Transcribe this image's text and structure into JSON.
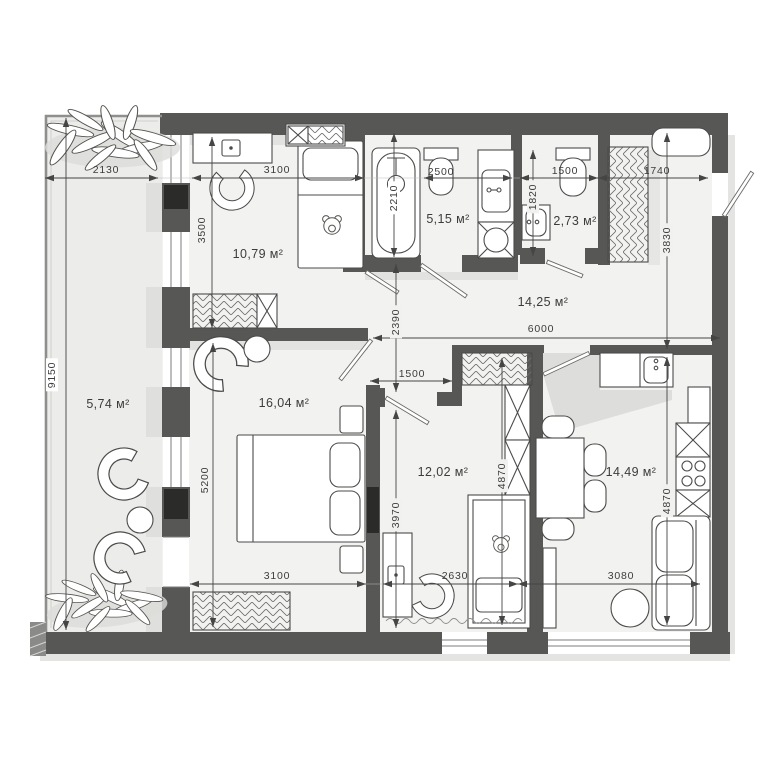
{
  "document": {
    "type": "apartment-floor-plan",
    "area_unit": "м²"
  },
  "colors": {
    "wall": "#575756",
    "floor": "#f2f2f0",
    "balcony_floor": "#ececea",
    "line": "#454544",
    "background": "#ffffff"
  },
  "rooms": [
    {
      "id": "balcony",
      "area_label": "5,74 м²",
      "furniture": [
        "plant",
        "lounge-chair",
        "side-table",
        "lounge-chair",
        "plant"
      ]
    },
    {
      "id": "bedroom-top",
      "area_label": "10,79 м²",
      "furniture": [
        "desk",
        "desk-chair",
        "single-bed",
        "teddy-bear",
        "wardrobe"
      ]
    },
    {
      "id": "bathroom",
      "area_label": "5,15 м²",
      "furniture": [
        "bathtub",
        "toilet",
        "sink-counter",
        "washing-machine"
      ]
    },
    {
      "id": "wc",
      "area_label": "2,73 м²",
      "furniture": [
        "sink",
        "toilet"
      ]
    },
    {
      "id": "hallway",
      "area_label": "14,25 м²",
      "furniture": [
        "wardrobe",
        "bench",
        "closet"
      ]
    },
    {
      "id": "bedroom-main",
      "area_label": "16,04 м²",
      "furniture": [
        "armchair",
        "side-table",
        "double-bed",
        "nightstand",
        "nightstand",
        "wardrobe"
      ]
    },
    {
      "id": "kids-room",
      "area_label": "12,02 м²",
      "furniture": [
        "wardrobe",
        "closet",
        "desk",
        "desk-chair",
        "crib",
        "teddy-bear"
      ]
    },
    {
      "id": "kitchen-living",
      "area_label": "14,49 м²",
      "furniture": [
        "kitchen-counter",
        "sink",
        "fridge",
        "stove",
        "cabinet",
        "dining-table",
        "chair",
        "sofa",
        "coffee-table"
      ]
    }
  ],
  "dimensions": [
    {
      "value": "2130",
      "orientation": "horizontal"
    },
    {
      "value": "3100",
      "orientation": "horizontal"
    },
    {
      "value": "2500",
      "orientation": "horizontal"
    },
    {
      "value": "1500",
      "orientation": "horizontal"
    },
    {
      "value": "1740",
      "orientation": "horizontal"
    },
    {
      "value": "9150",
      "orientation": "vertical"
    },
    {
      "value": "3500",
      "orientation": "vertical"
    },
    {
      "value": "2210",
      "orientation": "vertical"
    },
    {
      "value": "1820",
      "orientation": "vertical"
    },
    {
      "value": "3830",
      "orientation": "vertical"
    },
    {
      "value": "2390",
      "orientation": "vertical"
    },
    {
      "value": "6000",
      "orientation": "horizontal"
    },
    {
      "value": "1500",
      "orientation": "horizontal"
    },
    {
      "value": "5200",
      "orientation": "vertical"
    },
    {
      "value": "3970",
      "orientation": "vertical"
    },
    {
      "value": "4870",
      "orientation": "vertical"
    },
    {
      "value": "4870",
      "orientation": "vertical"
    },
    {
      "value": "3100",
      "orientation": "horizontal"
    },
    {
      "value": "2630",
      "orientation": "horizontal"
    },
    {
      "value": "3080",
      "orientation": "horizontal"
    }
  ]
}
